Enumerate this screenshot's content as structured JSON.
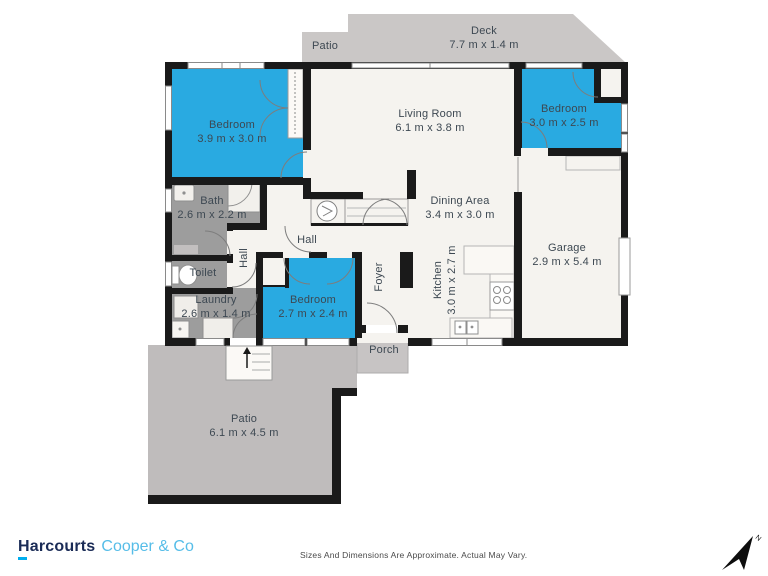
{
  "brand": {
    "name": "Harcourts",
    "suffix": "Cooper & Co"
  },
  "footer": {
    "disclaimer": "Sizes And Dimensions Are Approximate. Actual May Vary.",
    "compass": "N"
  },
  "colors": {
    "room_blue": "#29aae1",
    "wall_black": "#1a1a1a",
    "outdoor_gray": "#cac7c6",
    "utility_gray": "#9d9d9d",
    "floor_white": "#f5f3ef",
    "brand_navy": "#1a2b56",
    "brand_blue": "#56bde8",
    "brand_accent": "#00aeef"
  },
  "rooms": {
    "patio_top": {
      "name": "Patio"
    },
    "deck": {
      "name": "Deck",
      "dims": "7.7 m x 1.4 m"
    },
    "bedroom_left": {
      "name": "Bedroom",
      "dims": "3.9 m x 3.0 m"
    },
    "living_room": {
      "name": "Living Room",
      "dims": "6.1 m x 3.8 m"
    },
    "bedroom_top_right": {
      "name": "Bedroom",
      "dims": "3.0 m x 2.5 m"
    },
    "bath": {
      "name": "Bath",
      "dims": "2.6 m x 2.2 m"
    },
    "toilet": {
      "name": "Toilet"
    },
    "hall_side": {
      "name": "Hall"
    },
    "hall": {
      "name": "Hall"
    },
    "laundry": {
      "name": "Laundry",
      "dims": "2.6 m x 1.4 m"
    },
    "bedroom_bottom": {
      "name": "Bedroom",
      "dims": "2.7 m x 2.4 m"
    },
    "dining": {
      "name": "Dining Area",
      "dims": "3.4 m x 3.0 m"
    },
    "foyer": {
      "name": "Foyer"
    },
    "kitchen": {
      "name": "Kitchen",
      "dims": "3.0 m x 2.7 m"
    },
    "garage": {
      "name": "Garage",
      "dims": "2.9 m x 5.4 m"
    },
    "porch": {
      "name": "Porch"
    },
    "patio_bottom": {
      "name": "Patio",
      "dims": "6.1 m x 4.5 m"
    }
  }
}
